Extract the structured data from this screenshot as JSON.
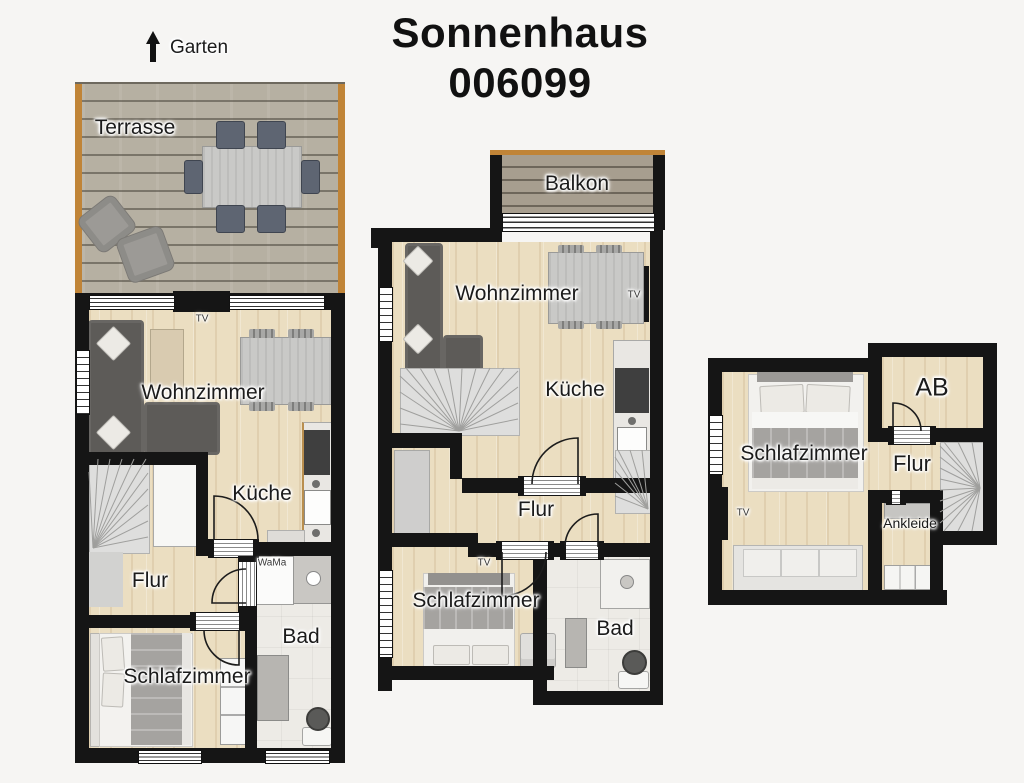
{
  "title": {
    "line1": "Sonnenhaus",
    "line2": "006099"
  },
  "compass": {
    "label": "Garten"
  },
  "colors": {
    "wall": "#151515",
    "floor_wood": "#ebdec1",
    "terrace_wood": "#b6b0a2",
    "balcony_wood": "#a79e8f",
    "bath_tile": "#edebe6",
    "trim_orange": "#c08437",
    "sofa_dark": "#5d5b58",
    "furniture_gray": "#c9c9c7",
    "stairs_gray": "#dededd"
  },
  "plans": [
    {
      "id": "ground-floor-with-terrace",
      "labels": {
        "terrasse": "Terrasse",
        "tv": "TV",
        "wohnzimmer": "Wohnzimmer",
        "kueche": "Küche",
        "wama": "WaMa",
        "flur": "Flur",
        "bad": "Bad",
        "schlafzimmer": "Schlafzimmer"
      }
    },
    {
      "id": "floor-with-balcony",
      "labels": {
        "balkon": "Balkon",
        "wohnzimmer": "Wohnzimmer",
        "tv_wohnzimmer": "TV",
        "kueche": "Küche",
        "flur": "Flur",
        "tv_schlafzimmer": "TV",
        "schlafzimmer": "Schlafzimmer",
        "bad": "Bad"
      }
    },
    {
      "id": "top-floor",
      "labels": {
        "schlafzimmer": "Schlafzimmer",
        "tv": "TV",
        "ab": "AB",
        "flur": "Flur",
        "ankleide": "Ankleide"
      }
    }
  ]
}
